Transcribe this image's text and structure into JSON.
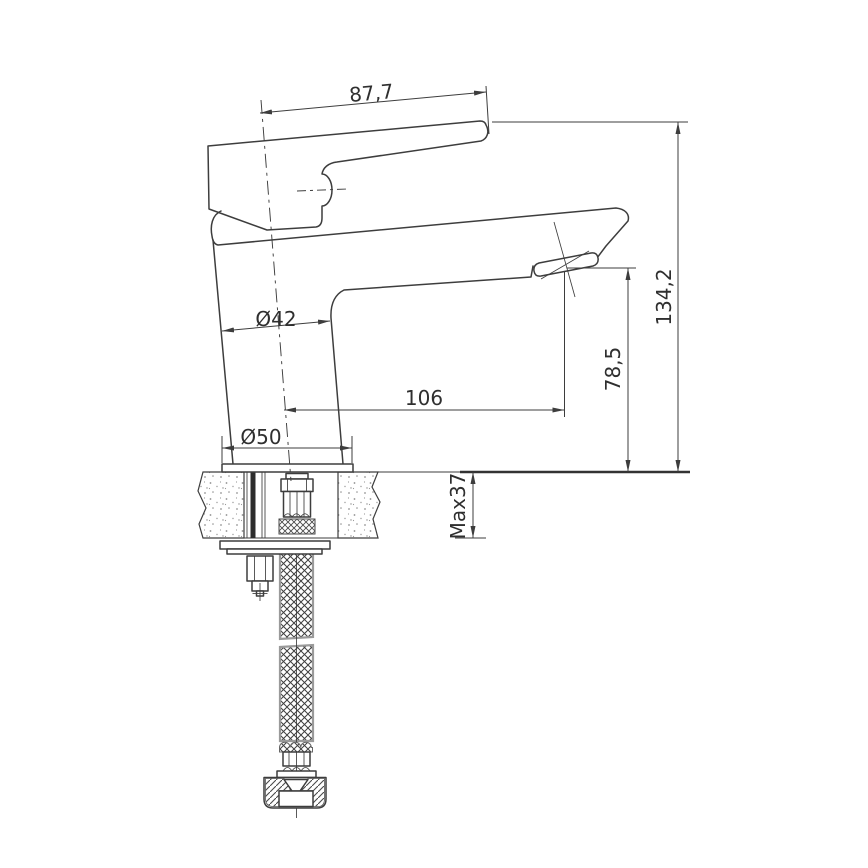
{
  "labels": {
    "handle_width": "87,7",
    "total_height": "134,2",
    "spout_height": "78,5",
    "spout_reach": "106",
    "body_diameter": "Ø42",
    "base_diameter": "Ø50",
    "max_countertop": "Max37"
  },
  "colors": {
    "line": "#3d3d3d",
    "text": "#2f2f2f",
    "hatch": "#555555",
    "stipple": "#8f8f8f",
    "background": "#ffffff"
  }
}
